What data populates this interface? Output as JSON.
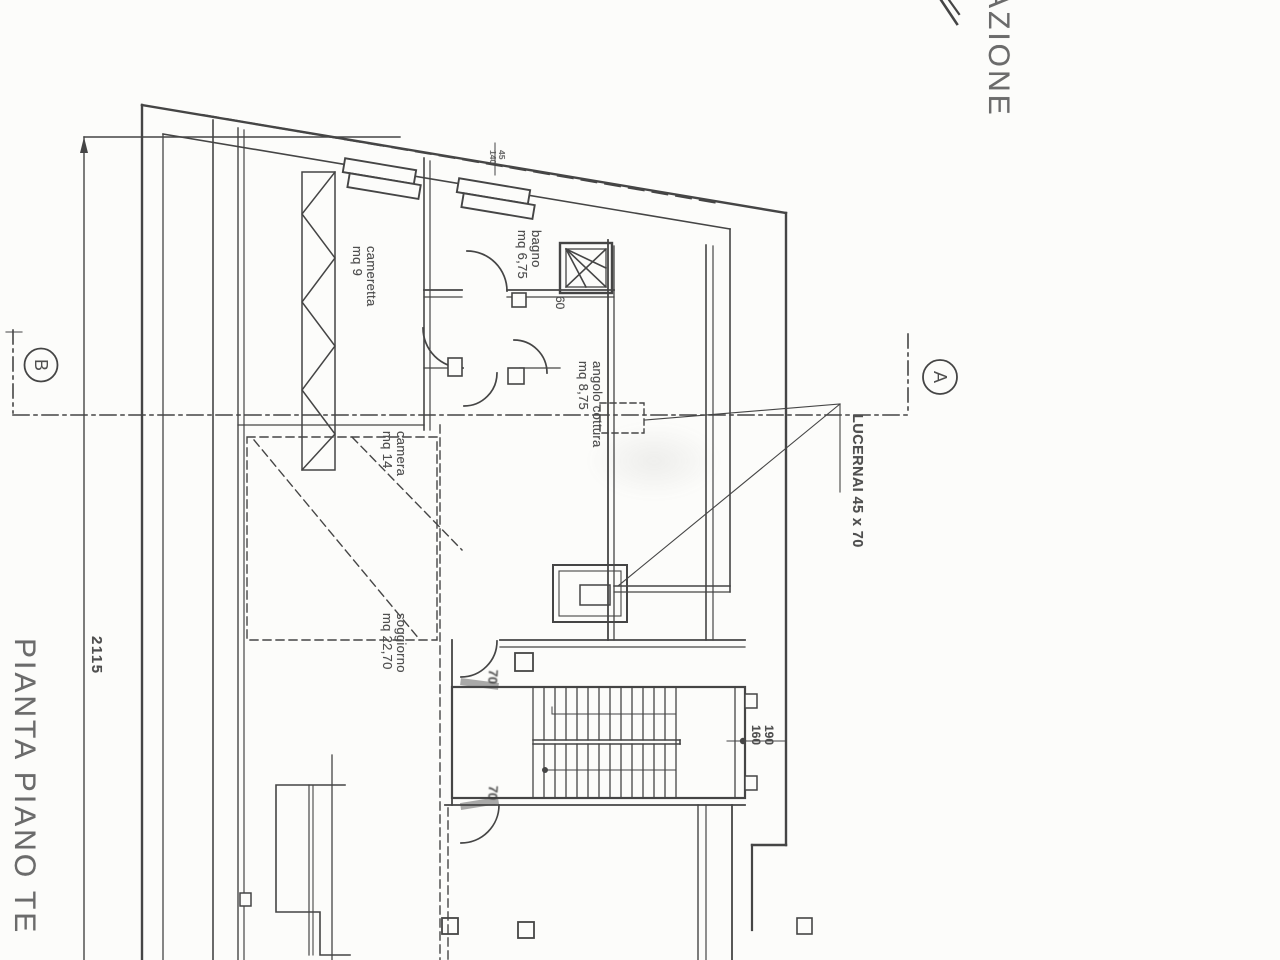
{
  "titles": {
    "plan_title_partial": "PIANTA PIANO TE",
    "header_partial": "AZIONE"
  },
  "section_markers": {
    "left": "B",
    "right": "A"
  },
  "overall_dimension": "2115",
  "rooms": [
    {
      "name": "cameretta",
      "area": "mq 9"
    },
    {
      "name": "bagno",
      "area": "mq 6,75"
    },
    {
      "name": "angolo cottura",
      "area": "mq 8,75"
    },
    {
      "name": "camera",
      "area": "mq 14"
    },
    {
      "name": "soggiorno",
      "area": "mq 22,70"
    }
  ],
  "skylight_note": "LUCERNAI 45 x 70",
  "dimensions": {
    "stair_opening_top": "190",
    "stair_opening_bottom": "160",
    "bagno_door": "60",
    "window_width": "45",
    "window_height": "140",
    "door_width_a": "70",
    "door_width_b": "70"
  },
  "colors": {
    "paper": "#fcfcfa",
    "ink": "#454545",
    "text": "#4f4f4f"
  }
}
